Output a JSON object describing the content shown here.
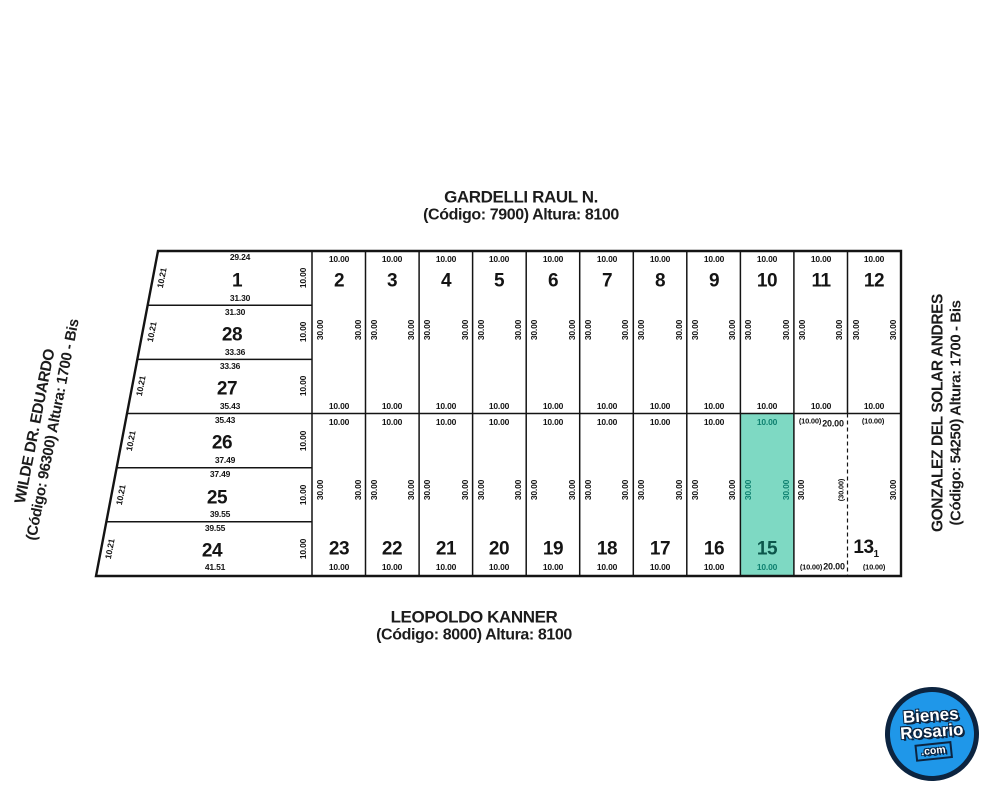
{
  "map": {
    "streets": {
      "top": {
        "name": "GARDELLI RAUL N.",
        "detail": "(Código: 7900) Altura: 8100"
      },
      "bottom": {
        "name": "LEOPOLDO KANNER",
        "detail": "(Código: 8000) Altura: 8100"
      },
      "left": {
        "name": "WILDE DR. EDUARDO",
        "detail": "(Código: 96300) Altura: 1700 - Bis"
      },
      "right": {
        "name": "GONZALEZ DEL SOLAR ANDRES",
        "detail": "(Código: 54250) Altura: 1700 - Bis"
      }
    },
    "labels": {
      "w10": "10.00",
      "w10p": "(10.00)",
      "w20": "20.00",
      "d30": "30.00",
      "d30p": "(30.00)",
      "slant": "10.21"
    },
    "left_lots": [
      {
        "number": "1",
        "top": "29.24",
        "bottom": "31.30"
      },
      {
        "number": "28",
        "top": "31.30",
        "bottom": "33.36"
      },
      {
        "number": "27",
        "top": "33.36",
        "bottom": "35.43"
      },
      {
        "number": "26",
        "top": "35.43",
        "bottom": "37.49"
      },
      {
        "number": "25",
        "top": "37.49",
        "bottom": "39.55"
      },
      {
        "number": "24",
        "top": "39.55",
        "bottom": "41.51"
      }
    ],
    "top_row": [
      "2",
      "3",
      "4",
      "5",
      "6",
      "7",
      "8",
      "9",
      "10",
      "11",
      "12"
    ],
    "bottom_row": [
      "23",
      "22",
      "21",
      "20",
      "19",
      "18",
      "17",
      "16"
    ],
    "highlighted_lot": {
      "number": "15",
      "fill": "#7ed9c3"
    },
    "merged_lot": {
      "number": "13",
      "subscript": "1"
    }
  },
  "logo": {
    "line1": "Bienes",
    "line2": "Rosario",
    "line3": ".com"
  }
}
